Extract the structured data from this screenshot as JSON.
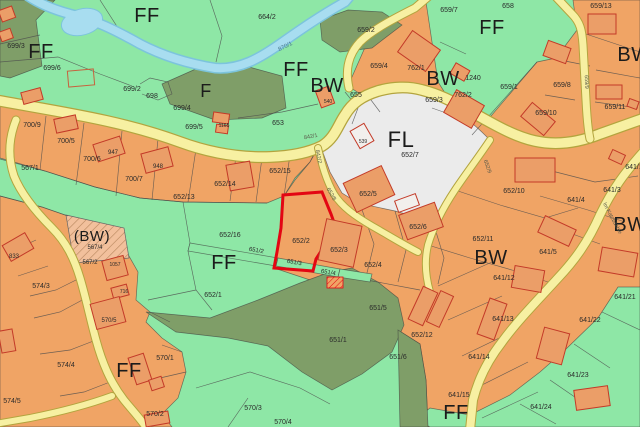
{
  "map": {
    "highlighted_parcel": "652/2",
    "colors": {
      "ff_green": "#8ee7a6",
      "forest_olive": "#7f9e68",
      "bw_orange": "#f0a465",
      "building_fill": "#eb9e68",
      "building_white": "#f2efec",
      "building_stroke": "#c33a28",
      "road_fill": "#f7f0a2",
      "road_edge": "#b3a43e",
      "stream": "#a8ddf0",
      "stream_edge": "#7cc4dc",
      "fl_gray": "#ebebeb",
      "hatch_bg": "#f2c09c",
      "highlight_red": "#e30613",
      "boundary": "#4d4d4d"
    },
    "zone_labels": [
      {
        "text": "FF",
        "x": 147,
        "y": 22,
        "size": 20
      },
      {
        "text": "FF",
        "x": 41,
        "y": 58,
        "size": 20
      },
      {
        "text": "FF",
        "x": 296,
        "y": 76,
        "size": 20
      },
      {
        "text": "F",
        "x": 206,
        "y": 97,
        "size": 18
      },
      {
        "text": "BW",
        "x": 327,
        "y": 92,
        "size": 20
      },
      {
        "text": "BW",
        "x": 443,
        "y": 85,
        "size": 20
      },
      {
        "text": "FF",
        "x": 492,
        "y": 34,
        "size": 20
      },
      {
        "text": "BW",
        "x": 634,
        "y": 61,
        "size": 20
      },
      {
        "text": "FL",
        "x": 401,
        "y": 147,
        "size": 22
      },
      {
        "text": "BW",
        "x": 491,
        "y": 264,
        "size": 20
      },
      {
        "text": "(BW)",
        "x": 92,
        "y": 241,
        "size": 15
      },
      {
        "text": "FF",
        "x": 224,
        "y": 269,
        "size": 20
      },
      {
        "text": "FF",
        "x": 129,
        "y": 377,
        "size": 20
      },
      {
        "text": "BW",
        "x": 630,
        "y": 231,
        "size": 20
      },
      {
        "text": "FF",
        "x": 456,
        "y": 419,
        "size": 20
      }
    ],
    "parcel_labels": [
      {
        "text": "699/3",
        "x": 16,
        "y": 48
      },
      {
        "text": "699/6",
        "x": 52,
        "y": 70
      },
      {
        "text": "699/2",
        "x": 132,
        "y": 91
      },
      {
        "text": "698",
        "x": 152,
        "y": 98
      },
      {
        "text": "699/4",
        "x": 182,
        "y": 110
      },
      {
        "text": "699/5",
        "x": 194,
        "y": 129
      },
      {
        "text": "664/2",
        "x": 267,
        "y": 19
      },
      {
        "text": "659/2",
        "x": 366,
        "y": 32
      },
      {
        "text": "658",
        "x": 508,
        "y": 8
      },
      {
        "text": "659/7",
        "x": 449,
        "y": 12
      },
      {
        "text": "659/13",
        "x": 601,
        "y": 8
      },
      {
        "text": "659/4",
        "x": 379,
        "y": 68
      },
      {
        "text": "762/1",
        "x": 416,
        "y": 70
      },
      {
        "text": "655",
        "x": 356,
        "y": 97
      },
      {
        "text": "540",
        "x": 328,
        "y": 103,
        "size": 5
      },
      {
        "text": "653",
        "x": 278,
        "y": 125
      },
      {
        "text": "1165",
        "x": 224,
        "y": 127,
        "size": 5
      },
      {
        "text": "1240",
        "x": 473,
        "y": 80
      },
      {
        "text": "762/2",
        "x": 463,
        "y": 97
      },
      {
        "text": "659/3",
        "x": 434,
        "y": 102
      },
      {
        "text": "659/1",
        "x": 509,
        "y": 89
      },
      {
        "text": "659/8",
        "x": 562,
        "y": 87
      },
      {
        "text": "659/10",
        "x": 546,
        "y": 115
      },
      {
        "text": "659/11",
        "x": 615,
        "y": 109
      },
      {
        "text": "700/9",
        "x": 32,
        "y": 127
      },
      {
        "text": "700/5",
        "x": 66,
        "y": 143
      },
      {
        "text": "700/6",
        "x": 92,
        "y": 161
      },
      {
        "text": "700/7",
        "x": 134,
        "y": 181
      },
      {
        "text": "947",
        "x": 113,
        "y": 154,
        "size": 6
      },
      {
        "text": "948",
        "x": 158,
        "y": 168,
        "size": 6
      },
      {
        "text": "567/1",
        "x": 30,
        "y": 170
      },
      {
        "text": "652/14",
        "x": 225,
        "y": 186
      },
      {
        "text": "652/15",
        "x": 280,
        "y": 173
      },
      {
        "text": "652/13",
        "x": 184,
        "y": 199
      },
      {
        "text": "652/16",
        "x": 230,
        "y": 237
      },
      {
        "text": "651/2",
        "x": 256,
        "y": 252,
        "size": 6,
        "rot": 10
      },
      {
        "text": "651/3",
        "x": 294,
        "y": 264,
        "size": 6,
        "rot": 10
      },
      {
        "text": "651/4",
        "x": 328,
        "y": 274,
        "size": 6,
        "rot": 10
      },
      {
        "text": "652/2",
        "x": 301,
        "y": 243
      },
      {
        "text": "652/3",
        "x": 339,
        "y": 252
      },
      {
        "text": "652/4",
        "x": 373,
        "y": 267
      },
      {
        "text": "652/5",
        "x": 368,
        "y": 196
      },
      {
        "text": "652/6",
        "x": 418,
        "y": 229
      },
      {
        "text": "652/7",
        "x": 410,
        "y": 157
      },
      {
        "text": "652/10",
        "x": 514,
        "y": 193
      },
      {
        "text": "652/11",
        "x": 483,
        "y": 241
      },
      {
        "text": "652/1",
        "x": 213,
        "y": 297
      },
      {
        "text": "539",
        "x": 363,
        "y": 143,
        "size": 5
      },
      {
        "text": "567/4",
        "x": 95,
        "y": 249,
        "size": 6
      },
      {
        "text": "567/2",
        "x": 90,
        "y": 264,
        "size": 6
      },
      {
        "text": "1057",
        "x": 115,
        "y": 266,
        "size": 5
      },
      {
        "text": "833",
        "x": 14,
        "y": 258,
        "size": 6
      },
      {
        "text": "716",
        "x": 124,
        "y": 293,
        "size": 5
      },
      {
        "text": "574/3",
        "x": 41,
        "y": 288
      },
      {
        "text": "574/4",
        "x": 66,
        "y": 367
      },
      {
        "text": "574/5",
        "x": 12,
        "y": 403
      },
      {
        "text": "570/5",
        "x": 109,
        "y": 322,
        "size": 6
      },
      {
        "text": "570/1",
        "x": 165,
        "y": 360
      },
      {
        "text": "570/2",
        "x": 155,
        "y": 416
      },
      {
        "text": "570/3",
        "x": 253,
        "y": 410
      },
      {
        "text": "570/4",
        "x": 283,
        "y": 424
      },
      {
        "text": "651/5",
        "x": 378,
        "y": 310
      },
      {
        "text": "651/1",
        "x": 338,
        "y": 342
      },
      {
        "text": "651/6",
        "x": 398,
        "y": 359
      },
      {
        "text": "641/4",
        "x": 576,
        "y": 202
      },
      {
        "text": "641/3",
        "x": 612,
        "y": 192
      },
      {
        "text": "641/5",
        "x": 548,
        "y": 254
      },
      {
        "text": "641/1",
        "x": 634,
        "y": 169
      },
      {
        "text": "652/12",
        "x": 422,
        "y": 337
      },
      {
        "text": "641/12",
        "x": 504,
        "y": 280
      },
      {
        "text": "641/13",
        "x": 503,
        "y": 321
      },
      {
        "text": "641/14",
        "x": 479,
        "y": 359
      },
      {
        "text": "641/15",
        "x": 459,
        "y": 397
      },
      {
        "text": "641/21",
        "x": 625,
        "y": 299
      },
      {
        "text": "641/22",
        "x": 590,
        "y": 322
      },
      {
        "text": "641/23",
        "x": 578,
        "y": 377
      },
      {
        "text": "641/24",
        "x": 541,
        "y": 409
      }
    ],
    "road_labels": [
      {
        "text": "842/1",
        "x": 311,
        "y": 138,
        "rot": -10
      },
      {
        "text": "842/2",
        "x": 317,
        "y": 157,
        "rot": 78
      },
      {
        "text": "652/8",
        "x": 330,
        "y": 195,
        "rot": 60
      },
      {
        "text": "652/9",
        "x": 486,
        "y": 167,
        "rot": 70
      },
      {
        "text": "659/9",
        "x": 585,
        "y": 82,
        "rot": 88
      },
      {
        "text": "Im Katzbächle",
        "x": 611,
        "y": 219,
        "rot": 62
      }
    ],
    "water_labels": [
      {
        "text": "870/1",
        "x": 286,
        "y": 48,
        "rot": -27
      }
    ],
    "buildings": [
      {
        "x": 22,
        "y": 90,
        "w": 20,
        "h": 12,
        "r": -15,
        "t": "s"
      },
      {
        "x": 0,
        "y": 8,
        "w": 14,
        "h": 12,
        "r": -20,
        "t": "s"
      },
      {
        "x": 0,
        "y": 30,
        "w": 12,
        "h": 10,
        "r": -20,
        "t": "s"
      },
      {
        "x": 68,
        "y": 70,
        "w": 26,
        "h": 16,
        "r": -5,
        "t": "o"
      },
      {
        "x": 55,
        "y": 117,
        "w": 22,
        "h": 14,
        "r": -12,
        "t": "s"
      },
      {
        "x": 95,
        "y": 140,
        "w": 28,
        "h": 18,
        "r": -18,
        "t": "s"
      },
      {
        "x": 143,
        "y": 150,
        "w": 28,
        "h": 20,
        "r": -15,
        "t": "s"
      },
      {
        "x": 213,
        "y": 113,
        "w": 16,
        "h": 10,
        "r": 8,
        "t": "s"
      },
      {
        "x": 216,
        "y": 125,
        "w": 12,
        "h": 8,
        "r": 8,
        "t": "s"
      },
      {
        "x": 228,
        "y": 163,
        "w": 24,
        "h": 26,
        "r": -10,
        "t": "s"
      },
      {
        "x": 316,
        "y": 90,
        "w": 18,
        "h": 14,
        "r": 70,
        "t": "s"
      },
      {
        "x": 352,
        "y": 128,
        "w": 20,
        "h": 16,
        "r": 60,
        "t": "w"
      },
      {
        "x": 402,
        "y": 38,
        "w": 34,
        "h": 26,
        "r": 35,
        "t": "s"
      },
      {
        "x": 448,
        "y": 96,
        "w": 32,
        "h": 26,
        "r": 30,
        "t": "s"
      },
      {
        "x": 452,
        "y": 66,
        "w": 16,
        "h": 12,
        "r": 30,
        "t": "s"
      },
      {
        "x": 545,
        "y": 44,
        "w": 24,
        "h": 16,
        "r": 20,
        "t": "s"
      },
      {
        "x": 588,
        "y": 14,
        "w": 28,
        "h": 20,
        "r": 0,
        "t": "s"
      },
      {
        "x": 523,
        "y": 110,
        "w": 30,
        "h": 18,
        "r": 40,
        "t": "s"
      },
      {
        "x": 596,
        "y": 85,
        "w": 26,
        "h": 14,
        "r": 0,
        "t": "s"
      },
      {
        "x": 348,
        "y": 173,
        "w": 42,
        "h": 32,
        "r": -25,
        "t": "s"
      },
      {
        "x": 515,
        "y": 158,
        "w": 40,
        "h": 24,
        "r": 0,
        "t": "s"
      },
      {
        "x": 402,
        "y": 208,
        "w": 38,
        "h": 26,
        "r": -20,
        "t": "s"
      },
      {
        "x": 396,
        "y": 197,
        "w": 22,
        "h": 12,
        "r": -20,
        "t": "w"
      },
      {
        "x": 322,
        "y": 222,
        "w": 36,
        "h": 42,
        "r": 12,
        "t": "s"
      },
      {
        "x": 540,
        "y": 222,
        "w": 34,
        "h": 18,
        "r": 25,
        "t": "s"
      },
      {
        "x": 610,
        "y": 152,
        "w": 14,
        "h": 10,
        "r": 25,
        "t": "s"
      },
      {
        "x": 628,
        "y": 100,
        "w": 10,
        "h": 8,
        "r": 20,
        "t": "s"
      },
      {
        "x": 600,
        "y": 250,
        "w": 36,
        "h": 24,
        "r": 10,
        "t": "s"
      },
      {
        "x": 483,
        "y": 300,
        "w": 18,
        "h": 38,
        "r": 20,
        "t": "s"
      },
      {
        "x": 513,
        "y": 268,
        "w": 30,
        "h": 22,
        "r": 10,
        "t": "s"
      },
      {
        "x": 540,
        "y": 330,
        "w": 26,
        "h": 32,
        "r": 15,
        "t": "s"
      },
      {
        "x": 575,
        "y": 388,
        "w": 34,
        "h": 20,
        "r": -8,
        "t": "s"
      },
      {
        "x": 415,
        "y": 288,
        "w": 16,
        "h": 36,
        "r": 25,
        "t": "s"
      },
      {
        "x": 433,
        "y": 292,
        "w": 14,
        "h": 34,
        "r": 25,
        "t": "s"
      },
      {
        "x": 5,
        "y": 238,
        "w": 26,
        "h": 18,
        "r": -30,
        "t": "s"
      },
      {
        "x": 104,
        "y": 258,
        "w": 22,
        "h": 20,
        "r": -15,
        "t": "s"
      },
      {
        "x": 112,
        "y": 286,
        "w": 16,
        "h": 11,
        "r": -15,
        "t": "s"
      },
      {
        "x": 93,
        "y": 300,
        "w": 30,
        "h": 26,
        "r": -15,
        "t": "s"
      },
      {
        "x": 132,
        "y": 355,
        "w": 16,
        "h": 28,
        "r": -18,
        "t": "s"
      },
      {
        "x": 150,
        "y": 378,
        "w": 13,
        "h": 11,
        "r": -18,
        "t": "s"
      },
      {
        "x": 145,
        "y": 413,
        "w": 24,
        "h": 12,
        "r": -10,
        "t": "s"
      },
      {
        "x": 0,
        "y": 330,
        "w": 14,
        "h": 22,
        "r": -10,
        "t": "s"
      }
    ]
  }
}
